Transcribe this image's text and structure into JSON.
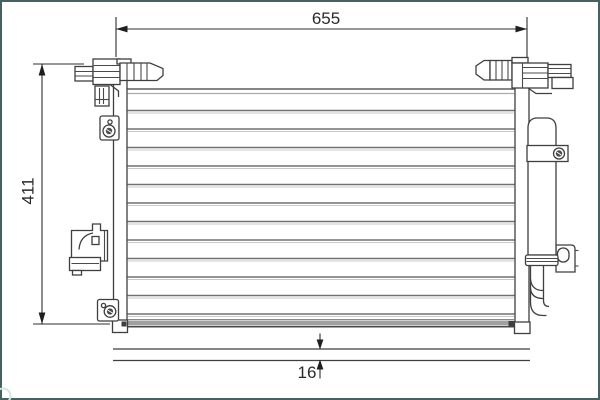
{
  "diagram": {
    "type": "technical-part-drawing",
    "subject": "vehicle-ac-condenser-with-receiver-drier",
    "dims": {
      "width": "655",
      "height": "411",
      "depth": "16"
    },
    "colors": {
      "frame_border": "#46615f",
      "drawing_line": "#3f3f3f",
      "tube_line": "#707070",
      "bottom_band": "#a0a0a0",
      "watermark": "#cfe8e3",
      "background": "#ffffff"
    },
    "watermark": {
      "shape": "circle-outline-bottom-left"
    }
  }
}
